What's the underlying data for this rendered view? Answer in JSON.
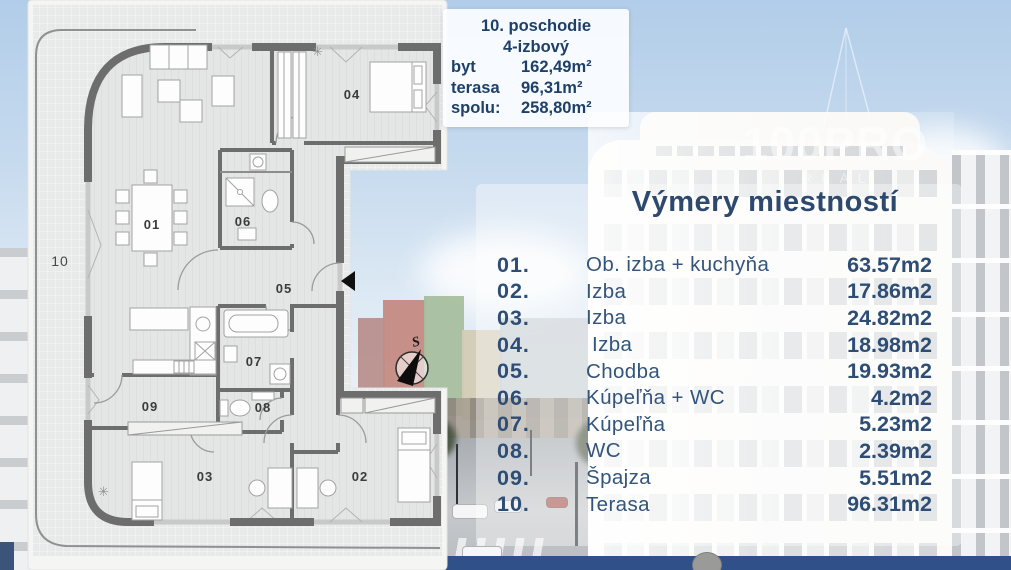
{
  "info_card": {
    "line1": "10. poschodie",
    "line2": "4-izbový",
    "rows": [
      {
        "label": "byt",
        "value": "162,49m²"
      },
      {
        "label": "terasa",
        "value": "96,31m²"
      },
      {
        "label": "spolu:",
        "value": "258,80m²"
      }
    ]
  },
  "rooms": {
    "title": "Výmery miestností",
    "rows": [
      {
        "num": "01.",
        "name": "Ob. izba + kuchyňa",
        "area": "63.57m2"
      },
      {
        "num": "02.",
        "name": "Izba",
        "area": "17.86m2"
      },
      {
        "num": "03.",
        "name": "Izba",
        "area": "24.82m2"
      },
      {
        "num": "04.",
        "name": "Izba",
        "area": "18.98m2"
      },
      {
        "num": "05.",
        "name": "Chodba",
        "area": "19.93m2"
      },
      {
        "num": "06.",
        "name": "Kúpeľňa + WC",
        "area": "4.2m2"
      },
      {
        "num": "07.",
        "name": "Kúpeľňa",
        "area": "5.23m2"
      },
      {
        "num": "08.",
        "name": "WC",
        "area": "2.39m2"
      },
      {
        "num": "09.",
        "name": "Špajza",
        "area": "5.51m2"
      },
      {
        "num": "10.",
        "name": "Terasa",
        "area": "96.31m2"
      }
    ]
  },
  "plan": {
    "labels": {
      "r01": "01",
      "r02": "02",
      "r03": "03",
      "r04": "04",
      "r05": "05",
      "r06": "06",
      "r07": "07",
      "r08": "08",
      "r09": "09",
      "r10": "10"
    },
    "compass": "S"
  },
  "watermark": {
    "line1": "100PRO",
    "line2": "REAL"
  },
  "colors": {
    "navy_text": "#2d4a6e",
    "bottom_bar": "#30508a",
    "wall": "#6d6d6d"
  }
}
